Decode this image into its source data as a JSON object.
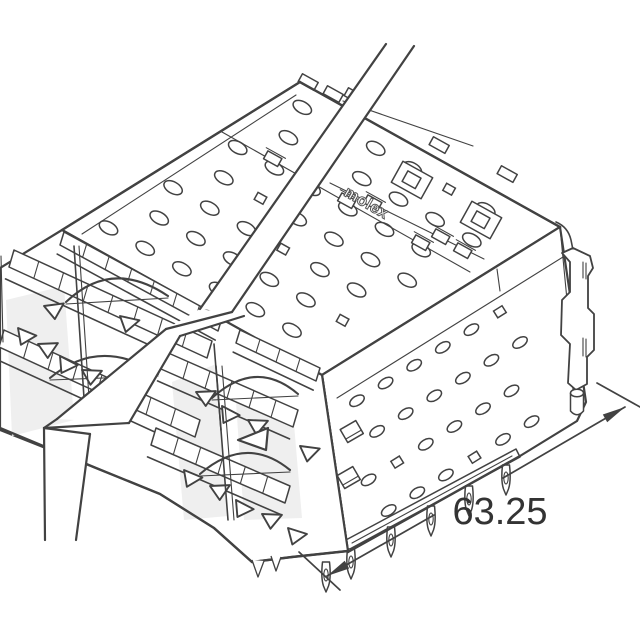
{
  "drawing": {
    "type": "isometric-technical-line-drawing",
    "subject": "stacked ganged SFP-style cage connector shown with diagonal break band",
    "brand_label": "molex",
    "dimension_label": "63.25",
    "colors": {
      "line": "#424242",
      "background": "#ffffff",
      "label_text": "#333333",
      "shade": "#efefef"
    }
  }
}
